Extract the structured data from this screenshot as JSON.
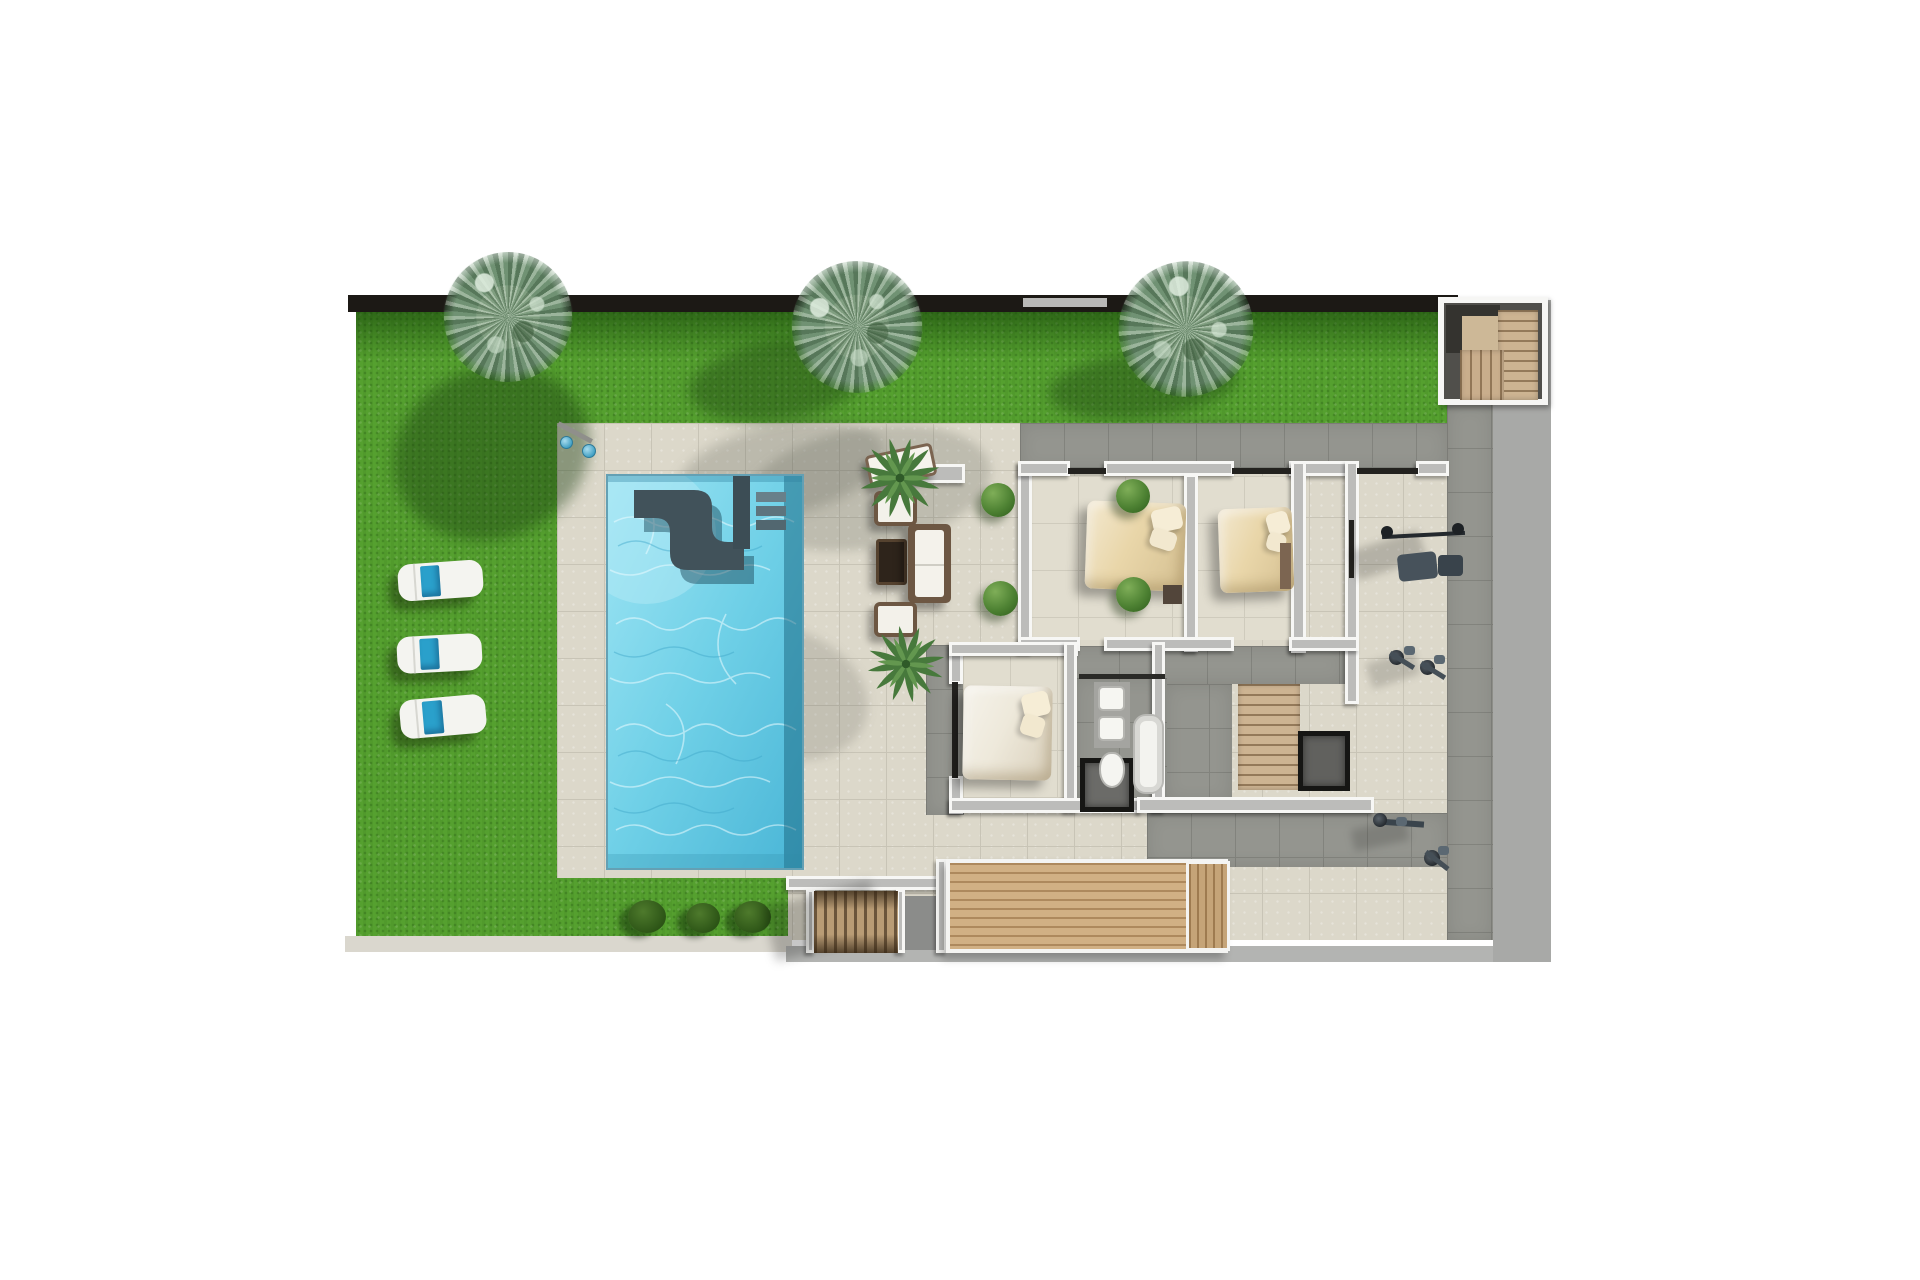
{
  "canvas": {
    "width": 1920,
    "height": 1280,
    "background": "#ffffff"
  },
  "palette": {
    "grass": "#55a02f",
    "hedge_shadow": "#0e3a04",
    "tile_light": "#dcd8ca",
    "tile_dark": "#94958f",
    "wall_white": "#f7f7f5",
    "wall_core": "#bcbcba",
    "pool_water": "#6fd0e7",
    "pool_bench": "#41525a",
    "wood_deck": "#d1b084",
    "wood_stairs": "#cdb492",
    "towel_blue": "#2aa0cb",
    "side_yard_gray": "#a8a9a7",
    "perimeter_wall": "#1c1915",
    "duvet_tan": "#e9d6a9",
    "duvet_white": "#eee9db"
  },
  "elements": [
    {
      "n": "side-yard-gray-band",
      "x": 1493,
      "y": 300,
      "w": 58,
      "h": 662,
      "bg": "#a8a9a7"
    },
    {
      "n": "terrace-tile-base",
      "c": "tile-light",
      "x": 557,
      "y": 423,
      "w": 936,
      "h": 517
    },
    {
      "n": "grass-left-field",
      "c": "grass",
      "x": 356,
      "y": 310,
      "w": 201,
      "h": 628
    },
    {
      "n": "grass-top-strip",
      "c": "grass",
      "x": 557,
      "y": 310,
      "w": 901,
      "h": 113
    },
    {
      "n": "grass-bottom-strip",
      "c": "grass",
      "x": 557,
      "y": 878,
      "w": 231,
      "h": 60
    },
    {
      "n": "hedge-shadow-top",
      "c": "hedge",
      "x": 356,
      "y": 312,
      "w": 1102,
      "h": 48
    },
    {
      "n": "perimeter-wall-top",
      "x": 348,
      "y": 295,
      "w": 1110,
      "h": 17,
      "bg": "#1c1915"
    },
    {
      "n": "perimeter-wall-light-segment",
      "x": 1023,
      "y": 298,
      "w": 84,
      "h": 9,
      "bg": "#b9b9b7"
    },
    {
      "n": "curb-bottom-left",
      "x": 345,
      "y": 936,
      "w": 447,
      "h": 16,
      "bg": "#dad7ce"
    },
    {
      "n": "street-line-bottom",
      "x": 786,
      "y": 946,
      "w": 707,
      "h": 16,
      "bg": "#b3b4b2"
    },
    {
      "n": "tree-shadow-1",
      "x": 392,
      "y": 368,
      "w": 200,
      "h": 170,
      "bg": "rgba(25,60,15,.42)",
      "br": "50%",
      "r": -22,
      "bl": 7
    },
    {
      "n": "tree-shadow-2-grass",
      "x": 688,
      "y": 342,
      "w": 180,
      "h": 78,
      "bg": "rgba(25,60,15,.40)",
      "br": "50%",
      "r": -8,
      "bl": 7
    },
    {
      "n": "tree-shadow-2-tile",
      "x": 676,
      "y": 424,
      "w": 210,
      "h": 92,
      "bg": "rgba(70,72,66,.22)",
      "br": "50%",
      "r": -12,
      "bl": 6
    },
    {
      "n": "tree-shadow-3-grass",
      "x": 1048,
      "y": 352,
      "w": 190,
      "h": 66,
      "bg": "rgba(25,60,15,.40)",
      "br": "50%",
      "r": -6,
      "bl": 7
    },
    {
      "n": "tree-shadow-3-tile",
      "x": 1052,
      "y": 424,
      "w": 215,
      "h": 62,
      "bg": "rgba(70,72,66,.22)",
      "br": "50%",
      "r": -8,
      "bl": 6
    },
    {
      "n": "palm-frond-shadow-pool",
      "x": 742,
      "y": 428,
      "w": 250,
      "h": 120,
      "bg": "rgba(70,74,66,.20)",
      "br": "50%",
      "r": -10,
      "bl": 5
    },
    {
      "n": "palm-frond-shadow-patio",
      "x": 690,
      "y": 628,
      "w": 180,
      "h": 130,
      "bg": "rgba(70,74,66,.17)",
      "br": "50%",
      "r": 18,
      "bl": 5
    },
    {
      "n": "swimming-pool",
      "c": "pool",
      "x": 606,
      "y": 474,
      "w": 198,
      "h": 396,
      "tpl": "pool-svg"
    },
    {
      "n": "outdoor-shower-pole",
      "x": 556,
      "y": 430,
      "w": 38,
      "h": 5,
      "bg": "#8f8f8b",
      "r": 28
    },
    {
      "n": "outdoor-shower-head-1",
      "c": "shower-head",
      "x": 560,
      "y": 436,
      "w": 13,
      "h": 13
    },
    {
      "n": "outdoor-shower-head-2",
      "c": "shower-head",
      "x": 582,
      "y": 444,
      "w": 14,
      "h": 14
    },
    {
      "n": "sun-lounger-1",
      "c": "lounger",
      "x": 398,
      "y": 562,
      "w": 85,
      "h": 37,
      "r": -4
    },
    {
      "n": "sun-lounger-2",
      "c": "lounger",
      "x": 397,
      "y": 635,
      "w": 85,
      "h": 37,
      "r": -3
    },
    {
      "n": "sun-lounger-3",
      "c": "lounger",
      "x": 400,
      "y": 697,
      "w": 86,
      "h": 39,
      "r": -5
    },
    {
      "n": "garden-bush-1",
      "c": "bush",
      "x": 628,
      "y": 900,
      "w": 38,
      "h": 33
    },
    {
      "n": "garden-bush-2",
      "c": "bush",
      "x": 686,
      "y": 903,
      "w": 34,
      "h": 30
    },
    {
      "n": "garden-bush-3",
      "c": "bush",
      "x": 734,
      "y": 901,
      "w": 37,
      "h": 32
    },
    {
      "n": "walkway-north-dark-tile",
      "c": "tile-dark",
      "x": 1020,
      "y": 423,
      "w": 427,
      "h": 47
    },
    {
      "n": "side-terrace-dark-tile",
      "c": "tile-dark",
      "x": 1447,
      "y": 404,
      "w": 46,
      "h": 536
    },
    {
      "n": "hall-dark-tile",
      "c": "tile-dark",
      "x": 1031,
      "y": 646,
      "w": 314,
      "h": 38
    },
    {
      "n": "corridor-dark-tile",
      "c": "tile-dark",
      "x": 1165,
      "y": 684,
      "w": 67,
      "h": 118
    },
    {
      "n": "bathroom-floor-tile",
      "c": "tile-dark",
      "x": 1075,
      "y": 678,
      "w": 92,
      "h": 122
    },
    {
      "n": "west-walkway-dark-tile",
      "c": "tile-dark",
      "x": 926,
      "y": 645,
      "w": 38,
      "h": 170
    },
    {
      "n": "south-strip-dark-tile",
      "c": "tile-dark",
      "x": 1147,
      "y": 813,
      "w": 300,
      "h": 54
    },
    {
      "n": "stair-landing-gray",
      "x": 897,
      "y": 896,
      "w": 43,
      "h": 54,
      "bg": "#8b8c8a"
    },
    {
      "n": "bedroom1-floor",
      "c": "tile-room",
      "x": 1031,
      "y": 476,
      "w": 153,
      "h": 164
    },
    {
      "n": "bedroom2-floor",
      "c": "tile-room",
      "x": 1197,
      "y": 476,
      "w": 95,
      "h": 164
    },
    {
      "n": "bedroom3-floor",
      "c": "tile-room",
      "x": 963,
      "y": 656,
      "w": 101,
      "h": 146
    },
    {
      "n": "wall-bedroom1-west",
      "c": "wall",
      "x": 1018,
      "y": 461,
      "w": 14,
      "h": 192
    },
    {
      "n": "wall-north-a",
      "c": "wall",
      "x": 1018,
      "y": 461,
      "w": 52,
      "h": 15
    },
    {
      "n": "wall-north-b",
      "c": "wall",
      "x": 1104,
      "y": 461,
      "w": 130,
      "h": 15
    },
    {
      "n": "wall-bedrooms-divider",
      "c": "wall",
      "x": 1184,
      "y": 474,
      "w": 14,
      "h": 178
    },
    {
      "n": "wall-north-c",
      "c": "wall",
      "x": 1289,
      "y": 461,
      "w": 60,
      "h": 15
    },
    {
      "n": "wall-bedroom2-east",
      "c": "wall",
      "x": 1291,
      "y": 461,
      "w": 15,
      "h": 192
    },
    {
      "n": "wall-gym-west",
      "c": "wall",
      "x": 1345,
      "y": 461,
      "w": 14,
      "h": 243
    },
    {
      "n": "wall-north-d",
      "c": "wall",
      "x": 1416,
      "y": 461,
      "w": 33,
      "h": 15
    },
    {
      "n": "wall-mid-a",
      "c": "wall",
      "x": 1018,
      "y": 637,
      "w": 62,
      "h": 14
    },
    {
      "n": "wall-mid-b",
      "c": "wall",
      "x": 1104,
      "y": 637,
      "w": 130,
      "h": 14
    },
    {
      "n": "wall-mid-c",
      "c": "wall",
      "x": 1289,
      "y": 637,
      "w": 70,
      "h": 14
    },
    {
      "n": "wall-bedroom3-west-top",
      "c": "wall",
      "x": 949,
      "y": 642,
      "w": 14,
      "h": 42
    },
    {
      "n": "wall-bedroom3-west-bottom",
      "c": "wall",
      "x": 949,
      "y": 776,
      "w": 14,
      "h": 38
    },
    {
      "n": "wall-bedroom3-north",
      "c": "wall",
      "x": 949,
      "y": 642,
      "w": 129,
      "h": 14
    },
    {
      "n": "wall-bathroom-west",
      "c": "wall",
      "x": 1064,
      "y": 642,
      "w": 13,
      "h": 170
    },
    {
      "n": "wall-bathroom-east",
      "c": "wall",
      "x": 1152,
      "y": 642,
      "w": 13,
      "h": 170
    },
    {
      "n": "wall-south-wing",
      "c": "wall",
      "x": 949,
      "y": 798,
      "w": 193,
      "h": 15
    },
    {
      "n": "wall-south-right",
      "c": "wall",
      "x": 1137,
      "y": 797,
      "w": 237,
      "h": 16
    },
    {
      "n": "wall-patio-south",
      "c": "wall",
      "x": 786,
      "y": 876,
      "w": 156,
      "h": 14
    },
    {
      "n": "wall-stair-west-a",
      "c": "wall",
      "x": 806,
      "y": 889,
      "w": 9,
      "h": 64
    },
    {
      "n": "wall-stair-west-b",
      "c": "wall",
      "x": 896,
      "y": 889,
      "w": 9,
      "h": 64
    },
    {
      "n": "wall-deck-left",
      "c": "wall",
      "x": 936,
      "y": 859,
      "w": 11,
      "h": 94
    },
    {
      "n": "slider-bedroom1-north",
      "x": 1068,
      "y": 468,
      "w": 38,
      "h": 6,
      "bg": "#23221f"
    },
    {
      "n": "slider-bedroom2-north",
      "x": 1232,
      "y": 468,
      "w": 59,
      "h": 6,
      "bg": "#23221f"
    },
    {
      "n": "slider-gym-north",
      "x": 1357,
      "y": 468,
      "w": 61,
      "h": 6,
      "bg": "#23221f"
    },
    {
      "n": "slider-bedroom3-west",
      "x": 952,
      "y": 682,
      "w": 6,
      "h": 96,
      "bg": "#23221f"
    },
    {
      "n": "door-bathroom-north",
      "x": 1079,
      "y": 674,
      "w": 86,
      "h": 5,
      "bg": "#2a2a27"
    },
    {
      "n": "window-gym-west",
      "x": 1349,
      "y": 520,
      "w": 5,
      "h": 58,
      "bg": "#23221f"
    },
    {
      "n": "interior-staircase",
      "c": "stairs-wood",
      "x": 1238,
      "y": 684,
      "w": 62,
      "h": 106
    },
    {
      "n": "stair-void",
      "c": "void",
      "x": 1298,
      "y": 731,
      "w": 52,
      "h": 60,
      "bg": "#61615e"
    },
    {
      "n": "shower-cabin",
      "c": "void",
      "x": 1080,
      "y": 758,
      "w": 54,
      "h": 54,
      "bg": "#6b6b68"
    },
    {
      "n": "exterior-stair-west-shadow",
      "x": 768,
      "y": 893,
      "w": 110,
      "h": 56,
      "bg": "rgba(0,0,0,.22)",
      "bl": 5,
      "r": -14
    },
    {
      "n": "exterior-stair-west",
      "c": "stairs-railing",
      "x": 814,
      "y": 891,
      "w": 84,
      "h": 62
    },
    {
      "n": "entrance-deck",
      "c": "deck-wood",
      "x": 946,
      "y": 859,
      "w": 282,
      "h": 94
    },
    {
      "n": "entrance-deck-ledge",
      "c": "deck-wood-v",
      "x": 1186,
      "y": 861,
      "w": 44,
      "h": 90
    },
    {
      "n": "vanity-counter",
      "x": 1094,
      "y": 682,
      "w": 36,
      "h": 66,
      "bg": "#a4a4a0"
    },
    {
      "n": "sink-1",
      "c": "sink",
      "x": 1098,
      "y": 686,
      "w": 27,
      "h": 25
    },
    {
      "n": "sink-2",
      "c": "sink",
      "x": 1098,
      "y": 716,
      "w": 27,
      "h": 25
    },
    {
      "n": "toilet",
      "c": "toilet",
      "x": 1099,
      "y": 752,
      "w": 26,
      "h": 36
    },
    {
      "n": "bathtub",
      "c": "tub",
      "x": 1133,
      "y": 714,
      "w": 31,
      "h": 80
    },
    {
      "n": "bed-bedroom1",
      "c": "bed",
      "x": 1086,
      "y": 502,
      "w": 99,
      "h": 88,
      "r": 2
    },
    {
      "n": "nightstand-bedroom1",
      "x": 1163,
      "y": 585,
      "w": 19,
      "h": 19,
      "bg": "#52453a"
    },
    {
      "n": "bed-bedroom2",
      "c": "bed",
      "x": 1219,
      "y": 508,
      "w": 74,
      "h": 84,
      "r": -2
    },
    {
      "n": "dresser-bedroom2",
      "x": 1280,
      "y": 543,
      "w": 11,
      "h": 46,
      "bg": "#7c6551"
    },
    {
      "n": "bed-bedroom3",
      "c": "bed bed-white",
      "x": 963,
      "y": 686,
      "w": 89,
      "h": 94,
      "r": 1
    },
    {
      "n": "garden-wall-segment",
      "c": "wall",
      "x": 891,
      "y": 464,
      "w": 74,
      "h": 19
    },
    {
      "n": "wicker-daybed",
      "c": "daybed",
      "x": 867,
      "y": 449,
      "w": 68,
      "h": 33,
      "r": -12
    },
    {
      "n": "wicker-armchair-1",
      "c": "armchair",
      "x": 874,
      "y": 491,
      "w": 43,
      "h": 35
    },
    {
      "n": "coffee-table",
      "c": "cTable",
      "x": 876,
      "y": 539,
      "w": 31,
      "h": 46,
      "bg": "#2e241b"
    },
    {
      "n": "wicker-sofa",
      "c": "sofa",
      "x": 908,
      "y": 524,
      "w": 43,
      "h": 79
    },
    {
      "n": "wicker-armchair-2",
      "c": "armchair",
      "x": 874,
      "y": 602,
      "w": 43,
      "h": 35
    },
    {
      "n": "boxwood-shrub-1",
      "c": "shrub",
      "x": 981,
      "y": 483,
      "w": 34,
      "h": 34
    },
    {
      "n": "boxwood-shrub-2",
      "c": "shrub",
      "x": 983,
      "y": 581,
      "w": 35,
      "h": 35
    },
    {
      "n": "boxwood-shrub-3",
      "c": "shrub",
      "x": 1116,
      "y": 479,
      "w": 34,
      "h": 34
    },
    {
      "n": "boxwood-shrub-4",
      "c": "shrub",
      "x": 1116,
      "y": 577,
      "w": 35,
      "h": 35
    },
    {
      "n": "gym-bench-shadow",
      "x": 1352,
      "y": 540,
      "w": 72,
      "h": 30,
      "bg": "rgba(0,0,0,.18)",
      "bl": 4,
      "r": -18
    },
    {
      "n": "gym-bench",
      "x": 1398,
      "y": 553,
      "w": 39,
      "h": 27,
      "bg": "#47525b",
      "br": "5px",
      "r": -6
    },
    {
      "n": "gym-bench-seat",
      "x": 1438,
      "y": 555,
      "w": 25,
      "h": 21,
      "bg": "#39434b",
      "br": "4px"
    },
    {
      "n": "gym-barbell",
      "x": 1382,
      "y": 533,
      "w": 83,
      "h": 4,
      "bg": "#24292e",
      "r": -3
    },
    {
      "n": "gym-plate-left",
      "x": 1381,
      "y": 526,
      "w": 12,
      "h": 12,
      "bg": "#1d2125",
      "br": "50%"
    },
    {
      "n": "gym-plate-right",
      "x": 1452,
      "y": 523,
      "w": 12,
      "h": 12,
      "bg": "#1d2125",
      "br": "50%"
    },
    {
      "n": "gym-machine-shadow-2",
      "x": 1368,
      "y": 656,
      "w": 50,
      "h": 26,
      "bg": "rgba(0,0,0,.15)",
      "bl": 4,
      "r": -18
    },
    {
      "n": "exercise-bike-1-wheel",
      "c": "gym-wheel",
      "x": 1389,
      "y": 650,
      "w": 15,
      "h": 15
    },
    {
      "n": "exercise-bike-1-frame",
      "x": 1388,
      "y": 658,
      "w": 28,
      "h": 5,
      "bg": "#454f57",
      "r": 32
    },
    {
      "n": "exercise-bike-1-seat",
      "x": 1404,
      "y": 646,
      "w": 11,
      "h": 9,
      "bg": "#5b6872",
      "br": "3px"
    },
    {
      "n": "exercise-bike-2-wheel",
      "c": "gym-wheel",
      "x": 1420,
      "y": 660,
      "w": 15,
      "h": 15
    },
    {
      "n": "exercise-bike-2-frame",
      "x": 1419,
      "y": 668,
      "w": 28,
      "h": 5,
      "bg": "#454f57",
      "r": 32
    },
    {
      "n": "exercise-bike-2-seat",
      "x": 1434,
      "y": 655,
      "w": 11,
      "h": 9,
      "bg": "#5b6872",
      "br": "3px"
    },
    {
      "n": "gym-machine-shadow-3",
      "x": 1352,
      "y": 824,
      "w": 56,
      "h": 22,
      "bg": "rgba(0,0,0,.15)",
      "bl": 4,
      "r": -12
    },
    {
      "n": "rowing-machine-rail",
      "x": 1376,
      "y": 820,
      "w": 48,
      "h": 6,
      "bg": "#3a444c",
      "r": 4
    },
    {
      "n": "rowing-machine-wheel",
      "c": "gym-wheel",
      "x": 1373,
      "y": 813,
      "w": 14,
      "h": 14
    },
    {
      "n": "rowing-machine-seat",
      "x": 1396,
      "y": 817,
      "w": 11,
      "h": 9,
      "bg": "#5b6872",
      "br": "3px"
    },
    {
      "n": "exercise-bike-3-wheel",
      "c": "gym-wheel",
      "x": 1424,
      "y": 850,
      "w": 16,
      "h": 16
    },
    {
      "n": "exercise-bike-3-frame",
      "x": 1423,
      "y": 858,
      "w": 28,
      "h": 5,
      "bg": "#454f57",
      "r": 38
    },
    {
      "n": "exercise-bike-3-seat",
      "x": 1438,
      "y": 846,
      "w": 11,
      "h": 9,
      "bg": "#5b6872",
      "br": "3px"
    },
    {
      "n": "exterior-stairbox",
      "c": "wall-box",
      "x": 1438,
      "y": 297,
      "w": 110,
      "h": 108
    },
    {
      "n": "stairbox-dark-corner",
      "x": 1446,
      "y": 305,
      "w": 54,
      "h": 48,
      "bg": "#34332f"
    },
    {
      "n": "stairbox-landing",
      "x": 1462,
      "y": 316,
      "w": 36,
      "h": 36,
      "bg": "#cdb897"
    },
    {
      "n": "stairbox-flight-east",
      "c": "stairs-wood",
      "x": 1498,
      "y": 310,
      "w": 40,
      "h": 90
    },
    {
      "n": "stairbox-flight-south",
      "c": "stairs-wood-v",
      "x": 1460,
      "y": 350,
      "w": 44,
      "h": 50
    },
    {
      "n": "palm-tree-terrace-1",
      "c": "palmwrap",
      "x": 856,
      "y": 434,
      "w": 88,
      "h": 88,
      "tpl": "palm-svg",
      "r": 15
    },
    {
      "n": "palm-tree-terrace-2",
      "c": "palmwrap",
      "x": 864,
      "y": 622,
      "w": 84,
      "h": 84,
      "tpl": "palm-svg",
      "r": -40
    },
    {
      "n": "garden-tree-1",
      "c": "tree",
      "x": 435,
      "y": 243,
      "w": 146,
      "h": 148,
      "r": 10
    },
    {
      "n": "garden-tree-2",
      "c": "tree",
      "x": 783,
      "y": 252,
      "w": 148,
      "h": 150,
      "r": -18
    },
    {
      "n": "garden-tree-3",
      "c": "tree",
      "x": 1110,
      "y": 252,
      "w": 152,
      "h": 154,
      "r": 35
    }
  ]
}
